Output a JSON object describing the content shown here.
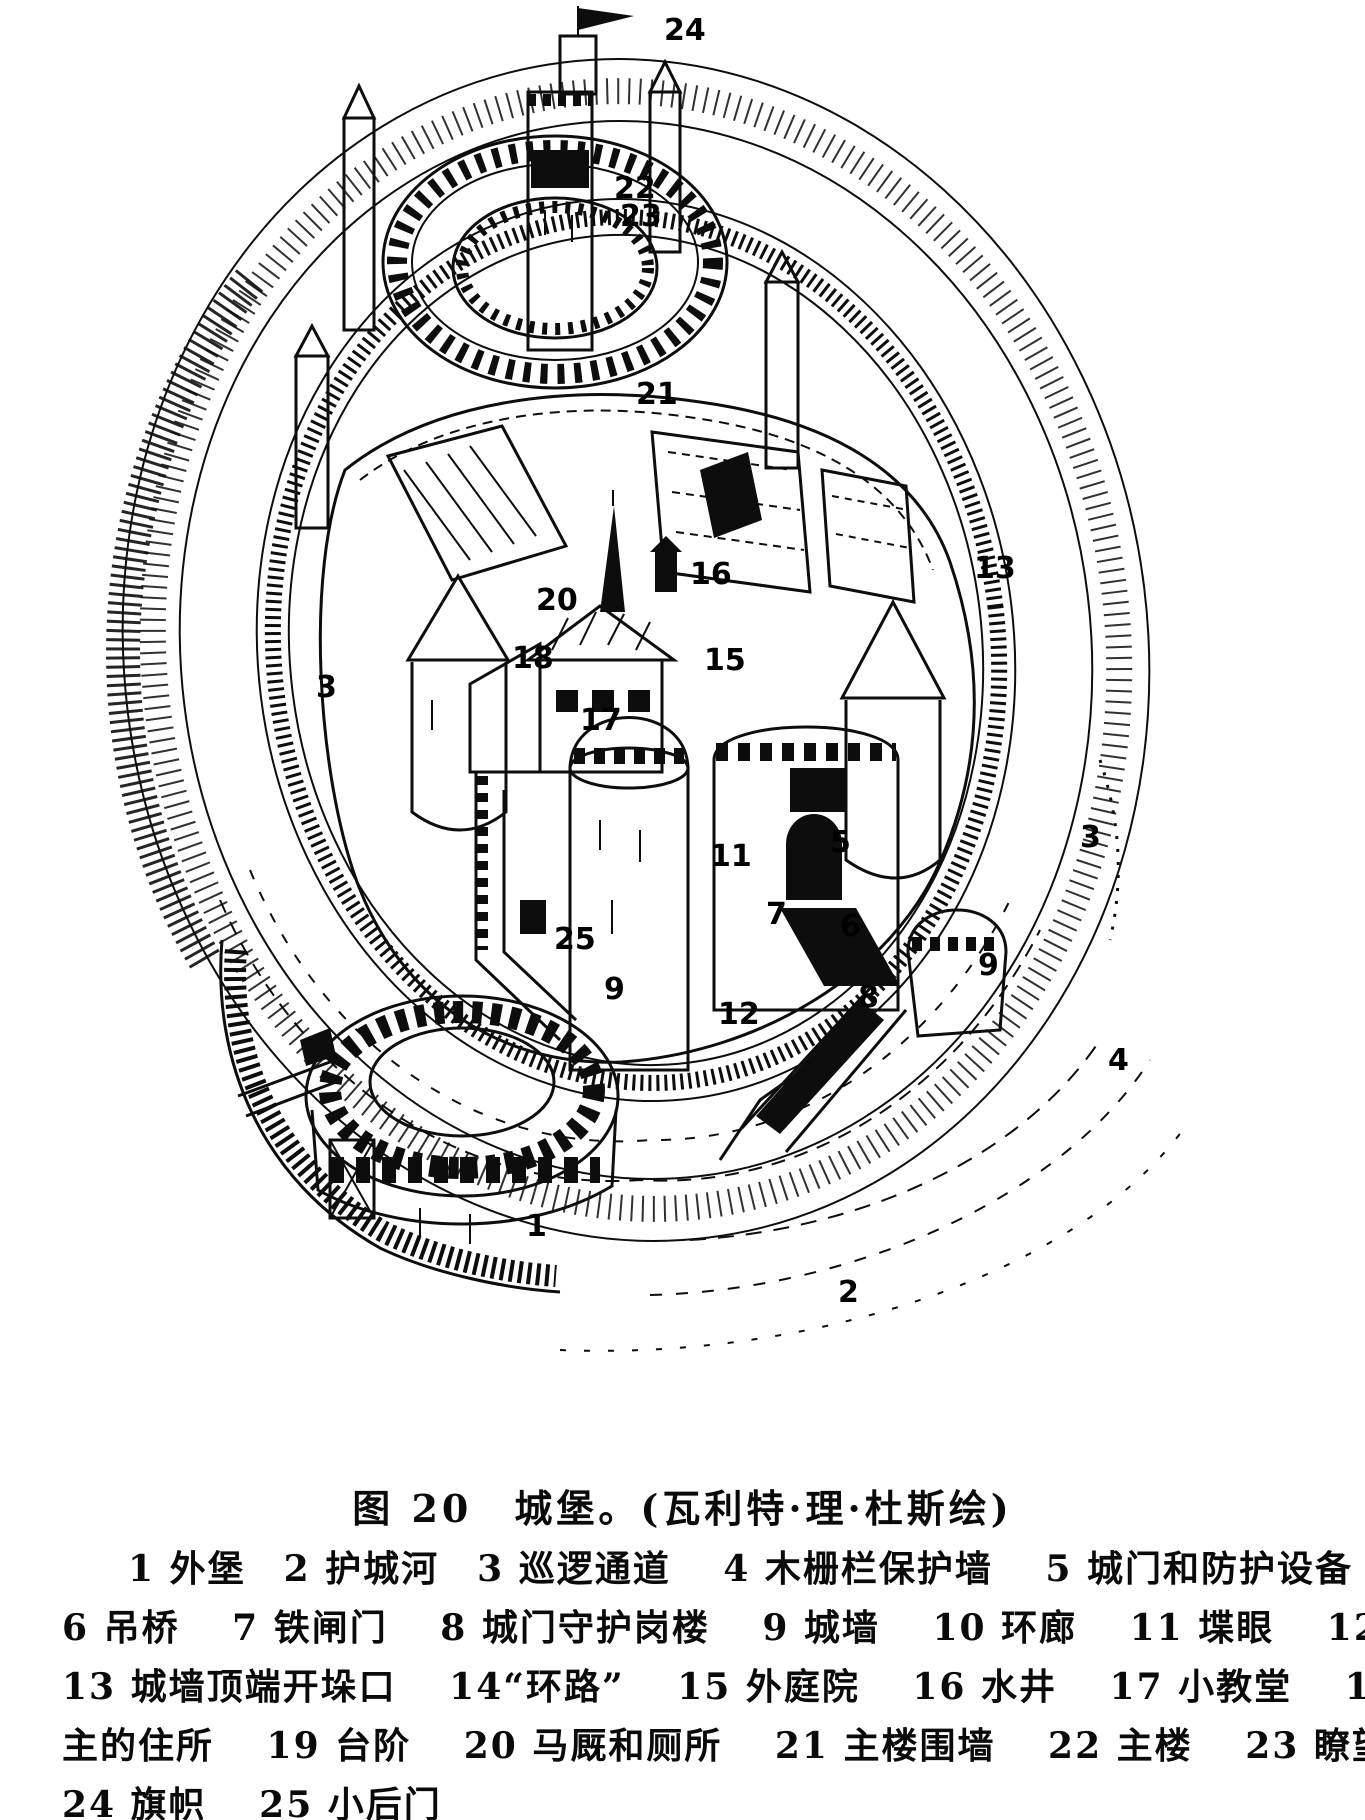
{
  "page": {
    "background": "#ffffff",
    "ink_color": "#0d0d0d",
    "description": "Scanned book page: black-and-white line drawing of a medieval motte-and-bailey castle with numbered callouts, caption and legend in Chinese"
  },
  "figure": {
    "caption": "图 20　城堡。(瓦利特·理·杜斯绘)",
    "callouts": [
      {
        "id": "24",
        "num": "24",
        "x": 664,
        "y": 40
      },
      {
        "id": "22",
        "num": "22",
        "x": 614,
        "y": 198
      },
      {
        "id": "23",
        "num": "23",
        "x": 620,
        "y": 226
      },
      {
        "id": "21",
        "num": "21",
        "x": 636,
        "y": 404
      },
      {
        "id": "16",
        "num": "16",
        "x": 690,
        "y": 584
      },
      {
        "id": "20",
        "num": "20",
        "x": 536,
        "y": 610
      },
      {
        "id": "13",
        "num": "13",
        "x": 974,
        "y": 578
      },
      {
        "id": "15",
        "num": "15",
        "x": 704,
        "y": 670
      },
      {
        "id": "18",
        "num": "18",
        "x": 512,
        "y": 668
      },
      {
        "id": "17",
        "num": "17",
        "x": 580,
        "y": 730
      },
      {
        "id": "3-left",
        "num": "3",
        "x": 316,
        "y": 697
      },
      {
        "id": "3-right",
        "num": "3",
        "x": 1080,
        "y": 847
      },
      {
        "id": "11",
        "num": "11",
        "x": 710,
        "y": 866
      },
      {
        "id": "5",
        "num": "5",
        "x": 830,
        "y": 852
      },
      {
        "id": "7",
        "num": "7",
        "x": 766,
        "y": 924
      },
      {
        "id": "6",
        "num": "6",
        "x": 840,
        "y": 936
      },
      {
        "id": "8",
        "num": "8",
        "x": 858,
        "y": 1007
      },
      {
        "id": "25",
        "num": "25",
        "x": 554,
        "y": 949
      },
      {
        "id": "9-left",
        "num": "9",
        "x": 604,
        "y": 999
      },
      {
        "id": "9-right",
        "num": "9",
        "x": 978,
        "y": 975
      },
      {
        "id": "12",
        "num": "12",
        "x": 718,
        "y": 1024
      },
      {
        "id": "4",
        "num": "4",
        "x": 1108,
        "y": 1070
      },
      {
        "id": "1",
        "num": "1",
        "x": 526,
        "y": 1236
      },
      {
        "id": "2",
        "num": "2",
        "x": 838,
        "y": 1302
      }
    ]
  },
  "legend": {
    "lines": [
      "1 外堡　2 护城河　3 巡逻通道　 4 木栅栏保护墙　 5 城门和防护设备",
      "6 吊桥　 7 铁闸门　 8 城门守护岗楼　 9 城墙　 10 环廊　 11 堞眼　 12 塔楼",
      "13 城墙顶端开垛口　 14“环路”　 15 外庭院　 16 水井　 17 小教堂　 18 领",
      "主的住所　 19 台阶　 20 马厩和厕所　 21 主楼围墙　 22 主楼　 23 瞭望塔",
      "24 旗帜　 25 小后门"
    ],
    "items": [
      {
        "num": "1",
        "label": "外堡"
      },
      {
        "num": "2",
        "label": "护城河"
      },
      {
        "num": "3",
        "label": "巡逻通道"
      },
      {
        "num": "4",
        "label": "木栅栏保护墙"
      },
      {
        "num": "5",
        "label": "城门和防护设备"
      },
      {
        "num": "6",
        "label": "吊桥"
      },
      {
        "num": "7",
        "label": "铁闸门"
      },
      {
        "num": "8",
        "label": "城门守护岗楼"
      },
      {
        "num": "9",
        "label": "城墙"
      },
      {
        "num": "10",
        "label": "环廊"
      },
      {
        "num": "11",
        "label": "堞眼"
      },
      {
        "num": "12",
        "label": "塔楼"
      },
      {
        "num": "13",
        "label": "城墙顶端开垛口"
      },
      {
        "num": "14",
        "label": "“环路”"
      },
      {
        "num": "15",
        "label": "外庭院"
      },
      {
        "num": "16",
        "label": "水井"
      },
      {
        "num": "17",
        "label": "小教堂"
      },
      {
        "num": "18",
        "label": "领主的住所"
      },
      {
        "num": "19",
        "label": "台阶"
      },
      {
        "num": "20",
        "label": "马厩和厕所"
      },
      {
        "num": "21",
        "label": "主楼围墙"
      },
      {
        "num": "22",
        "label": "主楼"
      },
      {
        "num": "23",
        "label": "瞭望塔"
      },
      {
        "num": "24",
        "label": "旗帜"
      },
      {
        "num": "25",
        "label": "小后门"
      }
    ]
  }
}
